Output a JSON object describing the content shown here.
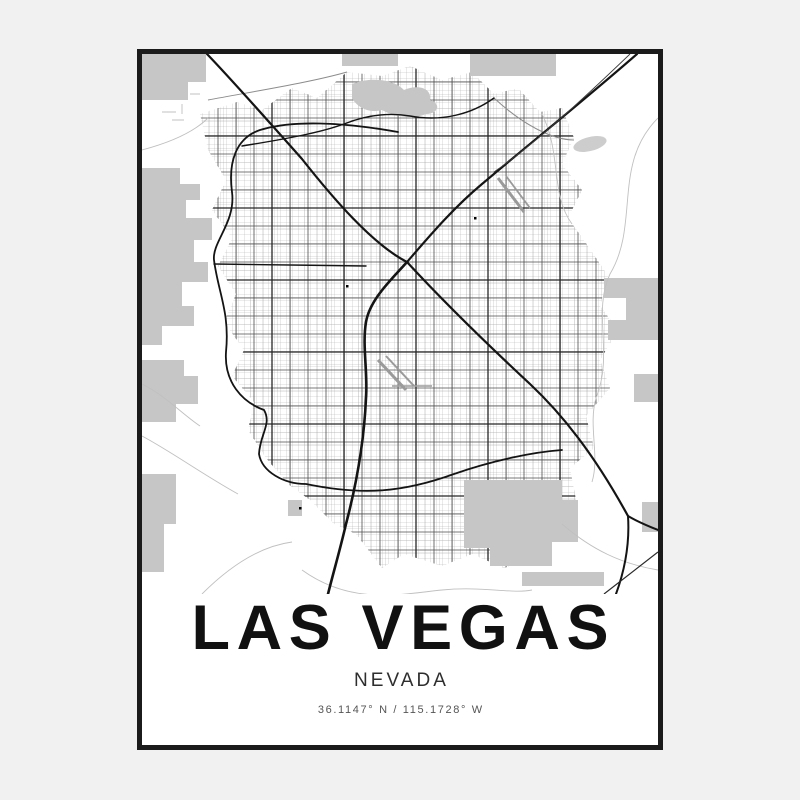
{
  "poster": {
    "title": "LAS VEGAS",
    "subtitle": "NEVADA",
    "coordinates": "36.1147° N / 115.1728° W"
  },
  "colors": {
    "page_bg": "#f1f1f1",
    "poster_bg": "#ffffff",
    "frame": "#1b1b1b",
    "land_gray": "#c6c6c6",
    "water_gray": "#cdcdcd",
    "road_dark": "#141414",
    "road_mid": "#4d4d4d",
    "road_arterial_dark": "#262626",
    "road_fine": "#b2b2b2",
    "road_faint": "#c0c0c0",
    "text_primary": "#111111",
    "text_secondary": "#2e2e2e",
    "text_tertiary": "#555555"
  }
}
